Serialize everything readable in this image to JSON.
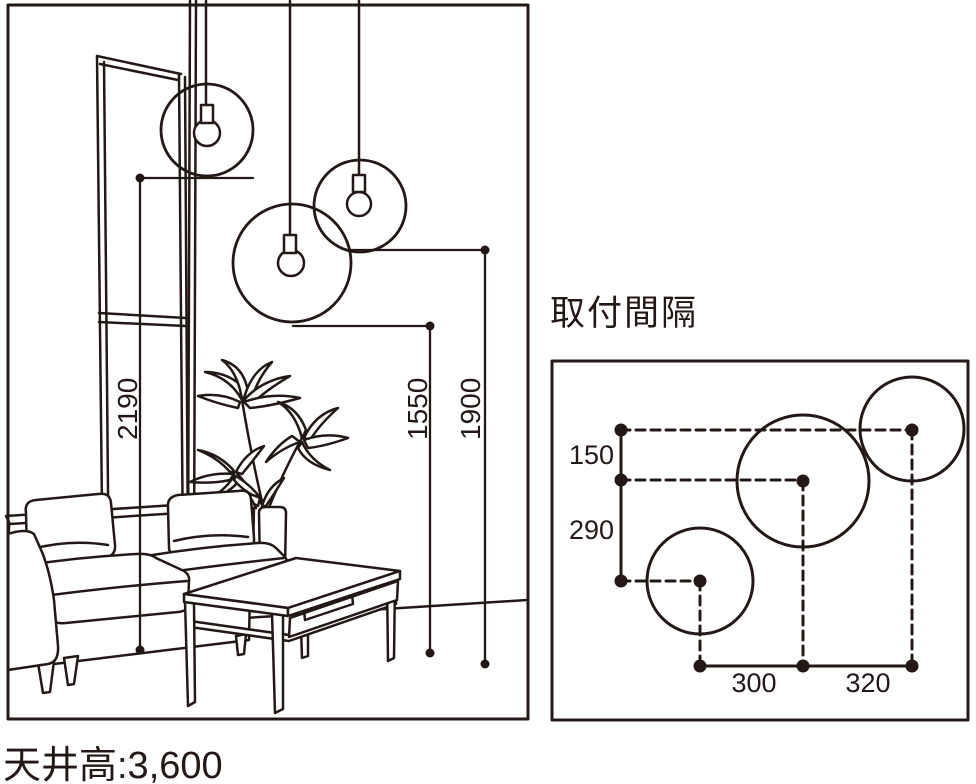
{
  "ink_color": "#231815",
  "background": "#ffffff",
  "left_panel": {
    "caption": "天井高:3,600",
    "dimensions": {
      "pendant_left": "2190",
      "pendant_center": "1550",
      "pendant_right": "1900"
    }
  },
  "right_panel": {
    "title": "取付間隔",
    "spacing": {
      "vertical_top": "150",
      "vertical_bottom": "290",
      "horizontal_left": "300",
      "horizontal_right": "320"
    }
  }
}
